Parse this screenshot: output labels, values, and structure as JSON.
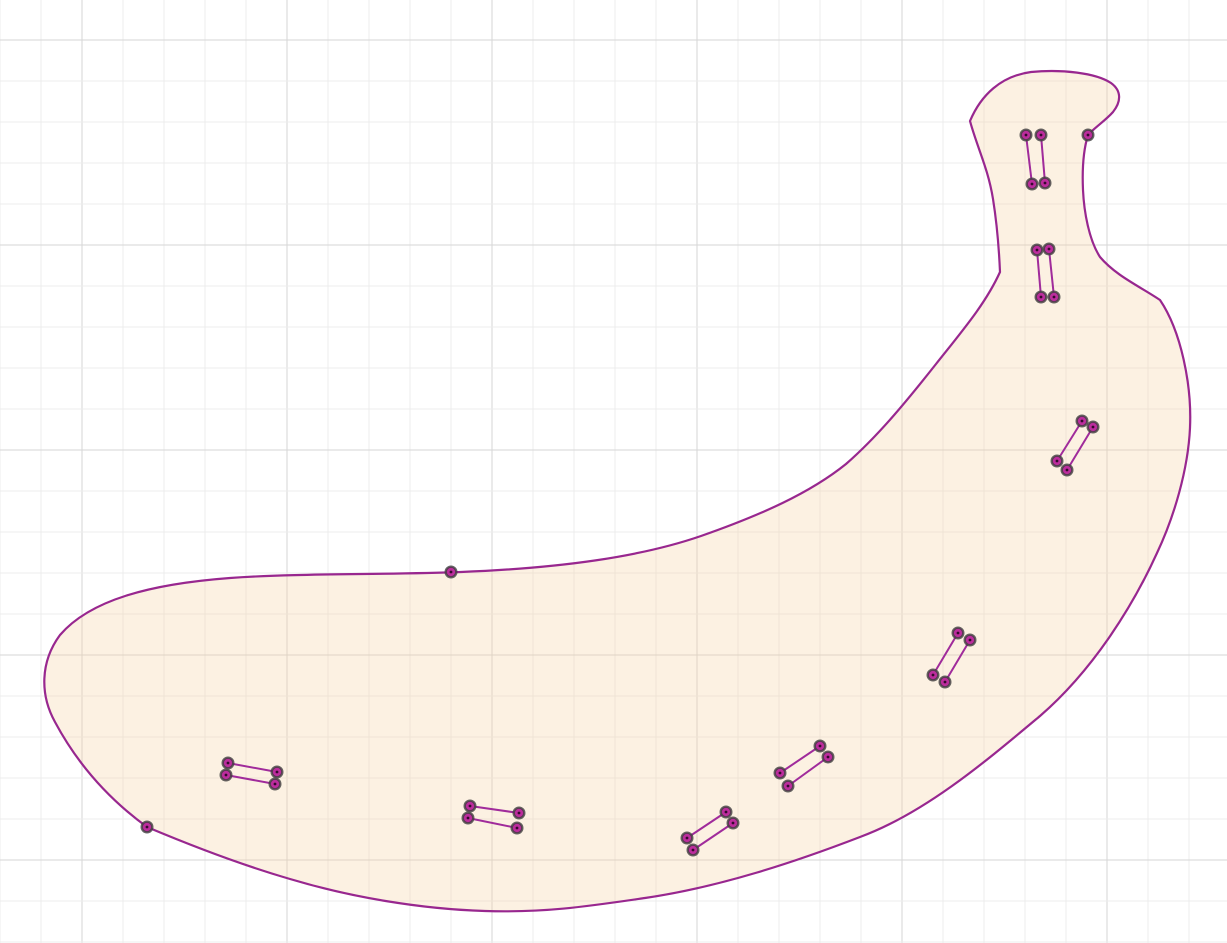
{
  "canvas": {
    "width": 1227,
    "height": 943,
    "background": "#ffffff"
  },
  "grid": {
    "minor_spacing": 41,
    "major_spacing": 205,
    "vertical_offset": 0,
    "vertical_major_offset": 82,
    "horizontal_offset": -1,
    "horizontal_major_offset": 40,
    "minor_color": "#ececec",
    "major_color": "#d6d6d6"
  },
  "colors": {
    "curve_stroke": "#98278F",
    "curve_fill": "rgba(246,210,160,0.30)",
    "segment_stroke": "#A02B9B",
    "point_fill": "#BC2C9D",
    "point_ring": "#3f3f3f",
    "point_center": "#35092e"
  },
  "banana_outline": {
    "path": "M 230 578 C 150 584 90 600 60 635 C 40 662 40 695 55 722 C 78 765 110 800 147 827 C 185 843 235 863 290 879 C 350 897 420 909 485 911 C 545 913 590 906 645 898 C 720 887 795 862 860 837 C 925 813 985 762 1040 716 C 1092 671 1132 608 1157 553 C 1174 517 1188 470 1190 428 C 1192 385 1181 331 1160 300 C 1141 287 1116 276 1100 257 C 1089 240 1084 212 1083 190 C 1082 168 1084 148 1088 135 C 1094 128 1105 121 1113 112 C 1121 102 1122 91 1111 83 C 1096 73 1062 69 1031 72 C 1001 76 981 95 970 121 C 977 147 988 168 993 199 C 997 224 999 249 1000 272 C 986 303 963 330 936 364 C 906 402 878 436 846 464 C 810 493 761 515 701 536 C 640 557 561 568 461 572 C 381 575 301 573 230 578 Z",
    "stroke_width": 2.2
  },
  "segments": [
    {
      "x1": 1026,
      "y1": 135,
      "x2": 1032,
      "y2": 184
    },
    {
      "x1": 1041,
      "y1": 135,
      "x2": 1045,
      "y2": 183
    },
    {
      "x1": 1037,
      "y1": 250,
      "x2": 1041,
      "y2": 297
    },
    {
      "x1": 1049,
      "y1": 249,
      "x2": 1054,
      "y2": 297
    },
    {
      "x1": 1082,
      "y1": 421,
      "x2": 1057,
      "y2": 461
    },
    {
      "x1": 1093,
      "y1": 427,
      "x2": 1067,
      "y2": 470
    },
    {
      "x1": 958,
      "y1": 633,
      "x2": 933,
      "y2": 675
    },
    {
      "x1": 970,
      "y1": 640,
      "x2": 945,
      "y2": 682
    },
    {
      "x1": 820,
      "y1": 746,
      "x2": 780,
      "y2": 773
    },
    {
      "x1": 828,
      "y1": 757,
      "x2": 788,
      "y2": 786
    },
    {
      "x1": 726,
      "y1": 812,
      "x2": 687,
      "y2": 838
    },
    {
      "x1": 733,
      "y1": 823,
      "x2": 693,
      "y2": 850
    },
    {
      "x1": 470,
      "y1": 806,
      "x2": 519,
      "y2": 813
    },
    {
      "x1": 468,
      "y1": 818,
      "x2": 517,
      "y2": 828
    },
    {
      "x1": 228,
      "y1": 763,
      "x2": 277,
      "y2": 772
    },
    {
      "x1": 226,
      "y1": 775,
      "x2": 275,
      "y2": 784
    }
  ],
  "free_points": [
    {
      "x": 147,
      "y": 827
    },
    {
      "x": 451,
      "y": 572
    },
    {
      "x": 1088,
      "y": 135
    }
  ],
  "point_style": {
    "radius": 5.3,
    "ring_width": 2.4,
    "center_radius": 1.4
  }
}
